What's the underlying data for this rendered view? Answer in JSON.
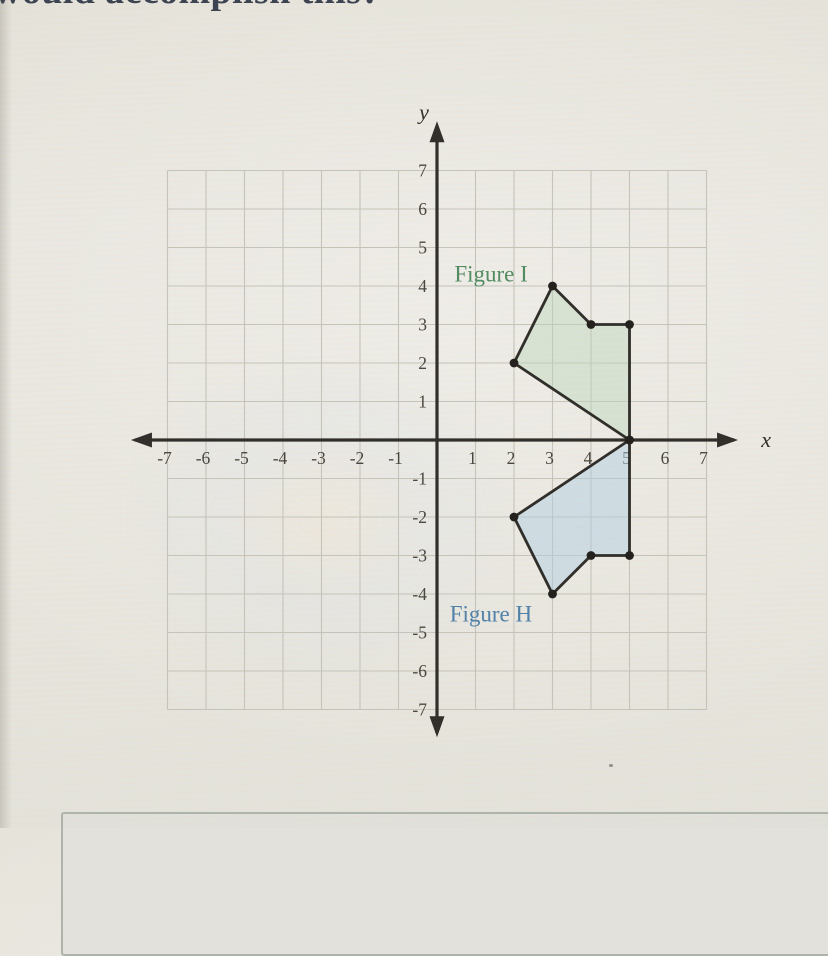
{
  "page": {
    "top_text_fragment": "would accomplish this?",
    "background_color": "#e8e5dd"
  },
  "chart_data": {
    "type": "line",
    "title": "",
    "xlabel": "x",
    "ylabel": "y",
    "xlim": [
      -7.5,
      7.5
    ],
    "ylim": [
      -7.5,
      7.5
    ],
    "grid": true,
    "grid_range": [
      -7,
      7
    ],
    "x_ticks": [
      -7,
      -6,
      -5,
      -4,
      -3,
      -2,
      -1,
      1,
      2,
      3,
      4,
      5,
      6,
      7
    ],
    "y_ticks": [
      -7,
      -6,
      -5,
      -4,
      -3,
      -2,
      -1,
      1,
      2,
      3,
      4,
      5,
      6,
      7
    ],
    "axis_color": "#2e2b27",
    "grid_color": "#c6c4ba",
    "tick_color": "#47433c",
    "vertex_dot_color": "#1f1d1a",
    "series": [
      {
        "name": "Figure I",
        "label": "Figure I",
        "points": [
          [
            2,
            2
          ],
          [
            3,
            4
          ],
          [
            4,
            3
          ],
          [
            5,
            3
          ],
          [
            5,
            0
          ]
        ],
        "closed": true,
        "fill": "#b9d6ba",
        "fill_opacity": 0.42,
        "stroke": "#2c2a26",
        "label_color": "#4f8a5f",
        "label_pos": [
          0.45,
          4.12
        ]
      },
      {
        "name": "Figure H",
        "label": "Figure H",
        "points": [
          [
            2,
            -2
          ],
          [
            3,
            -4
          ],
          [
            4,
            -3
          ],
          [
            5,
            -3
          ],
          [
            5,
            0
          ]
        ],
        "closed": true,
        "fill": "#afcfe3",
        "fill_opacity": 0.48,
        "stroke": "#2c2a26",
        "label_color": "#4d7fa8",
        "label_pos": [
          0.33,
          -4.72
        ]
      }
    ]
  }
}
